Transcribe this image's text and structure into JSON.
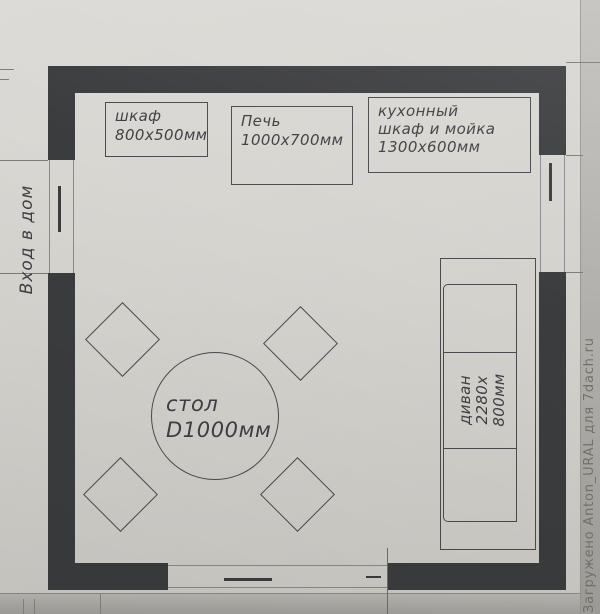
{
  "photo": {
    "watermark": "Загружено Anton_URAL для 7dach.ru"
  },
  "plan": {
    "entrance_label": "Вход в дом",
    "furniture": {
      "cabinet": {
        "name": "шкаф",
        "size": "800х500мм"
      },
      "stove": {
        "name": "Печь",
        "size": "1000х700мм"
      },
      "kitchen_unit": {
        "name_line1": "кухонный",
        "name_line2": "шкаф и мойка",
        "size": "1300х600мм"
      },
      "table": {
        "name": "стол",
        "size": "D1000мм"
      },
      "sofa": {
        "name": "диван",
        "size_line1": "2280х",
        "size_line2": "800мм"
      },
      "chairs": {
        "count": 4
      }
    },
    "colors": {
      "wall": "#3b3c3e",
      "line": "#4b4b4e",
      "text": "#3f4044",
      "paper": "#d5d3ce",
      "watermark_text": "#73726d"
    }
  }
}
